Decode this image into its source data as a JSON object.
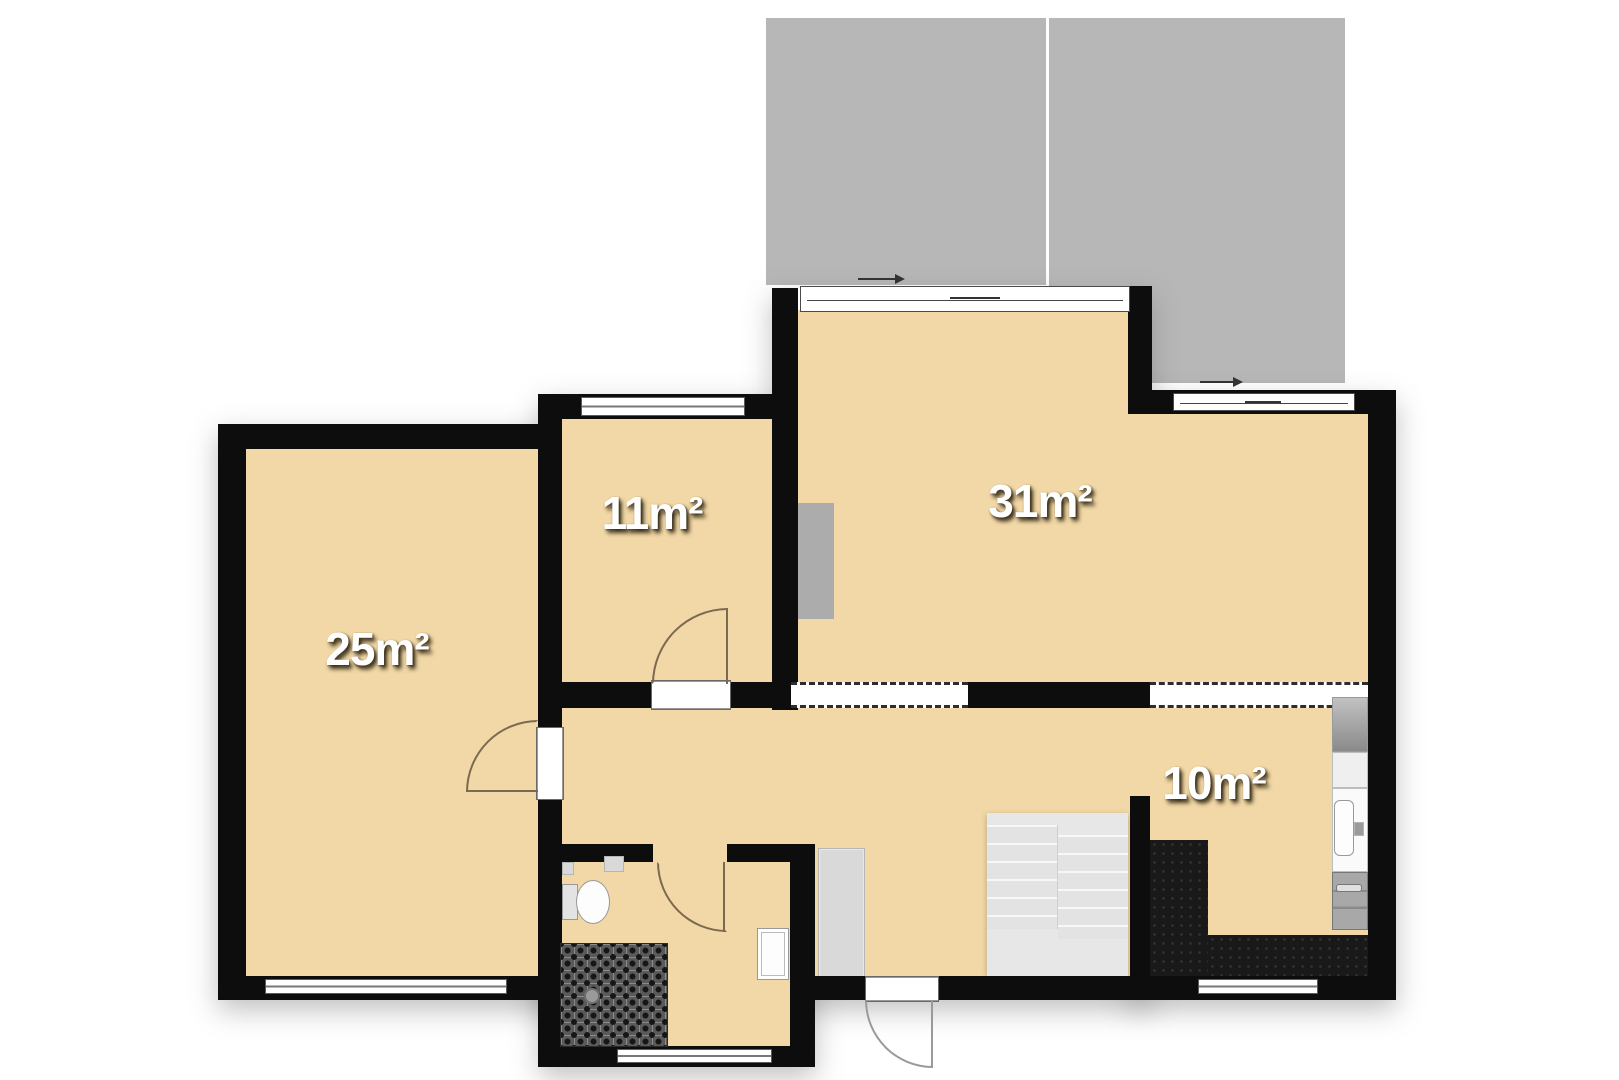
{
  "title": "apartment-floor-plan",
  "rooms": [
    {
      "id": "room-25",
      "label": "25m²"
    },
    {
      "id": "room-11",
      "label": "11m²"
    },
    {
      "id": "room-31",
      "label": "31m²"
    },
    {
      "id": "room-10",
      "label": "10m²"
    }
  ],
  "colors": {
    "floor": "#f2d8a6",
    "wall": "#0d0d0d",
    "terrace": "#b7b7b7",
    "dark_tile": "#191919",
    "stairs": "#e7e7e7",
    "fixture_gray": "#d9d9d9",
    "door_arc_interior": "#7b6a50",
    "door_arc_exterior": "#9a9a9a",
    "label_text": "#ffffff"
  },
  "fixtures": [
    "terrace",
    "sliding-door",
    "sliding-door",
    "window",
    "window",
    "window",
    "window",
    "window",
    "door",
    "door",
    "door",
    "entrance-door",
    "open-passage",
    "open-passage",
    "staircase",
    "wardrobe",
    "radiator",
    "toilet",
    "bathroom-sink",
    "washbasin",
    "shower-tiled-floor",
    "floor-drain",
    "fridge",
    "kitchen-cabinet",
    "kitchen-sink",
    "faucet",
    "stove"
  ]
}
